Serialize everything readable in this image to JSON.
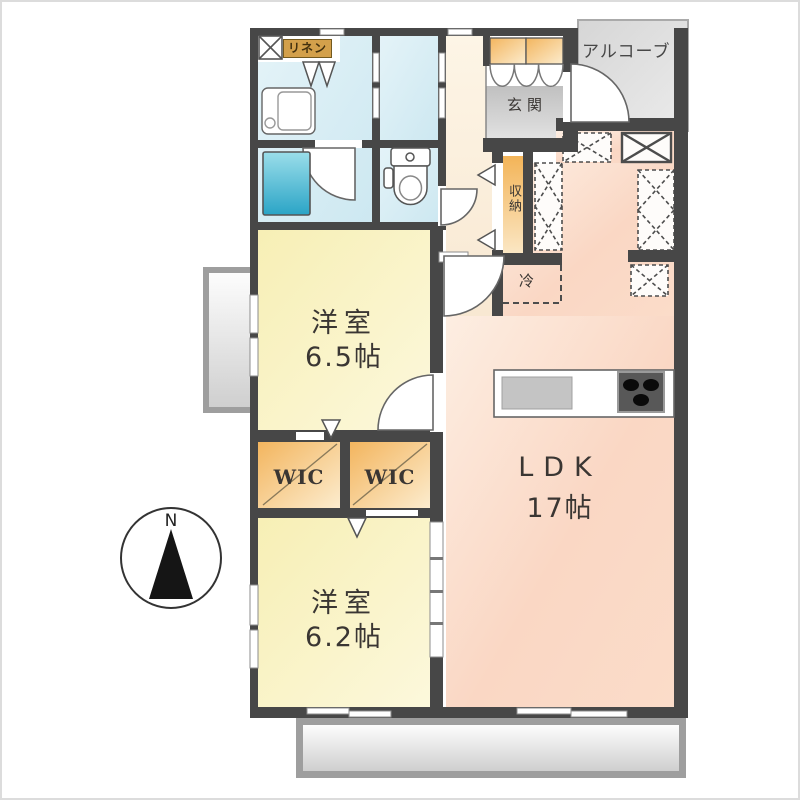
{
  "floorplan": {
    "labels": {
      "north": "N",
      "alcove": "アルコーブ",
      "linen": "リネン",
      "entrance": "玄関",
      "storage": "収納",
      "fridge": "冷",
      "wic_left": "WIC",
      "wic_right": "WIC"
    },
    "rooms": {
      "bedroom1": {
        "name": "洋室",
        "size": "6.5帖"
      },
      "bedroom2": {
        "name": "洋室",
        "size": "6.2帖"
      },
      "ldk": {
        "name": "LDK",
        "size": "17帖"
      }
    },
    "colors": {
      "wall": "#474747",
      "wet_room": "#d6ecf4",
      "bedroom": "#f8f1c0",
      "wic": "#f4bb64",
      "ldk": "#fbd9c6",
      "corridor": "#fdf3e2",
      "entrance_floor": "#c9c9c9",
      "alcove": "#dddddd",
      "bathtub": "#35aac9",
      "balcony": "#d9d9d9",
      "linen_badge": "#d3a04b"
    }
  }
}
